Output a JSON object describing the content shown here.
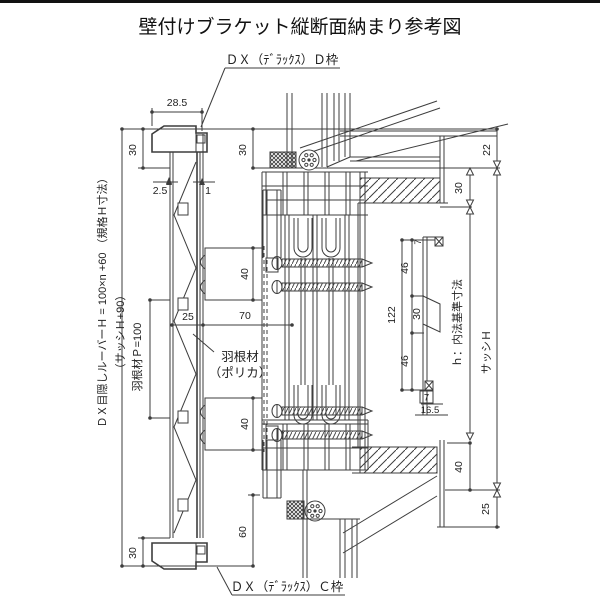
{
  "title": "壁付けブラケット縦断面納まり参考図",
  "labels": {
    "top_frame": "ＤＸ（ﾃﾞﾗｯｸｽ）Ｄ枠",
    "bottom_frame": "ＤＸ（ﾃﾞﾗｯｸｽ）Ｃ枠",
    "blade_line1": "羽根材",
    "blade_line2": "（ポリカ）",
    "louver_height_formula": "ＤＸ目隠しルーバーＨ = 100×n +60 （規格Ｈ寸法）",
    "sash_relation": "（サッシＨ+90）",
    "blade_pitch": "羽根材Ｐ=100",
    "inner_standard": "ｈ：内法基準寸法",
    "sash_height": "サッシＨ"
  },
  "dims": {
    "cap_width": "28.5",
    "cap_h_left": "30",
    "cap_h_right": "30",
    "gap": "2.5",
    "wall_t": "1",
    "blade_w_top": "40",
    "blade_w_bottom": "40",
    "offset25": "25",
    "offset70": "70",
    "bottom60": "60",
    "bottom30": "30",
    "right22": "22",
    "right30": "30",
    "right40": "40",
    "right25": "25",
    "det122": "122",
    "det46a": "46",
    "det30": "30",
    "det46b": "46",
    "det7a": "7",
    "det7b": "7",
    "det16_5": "16.5"
  },
  "colors": {
    "line": "#3d3d3d",
    "text": "#222222",
    "background": "#ffffff",
    "bar": "#111111"
  }
}
